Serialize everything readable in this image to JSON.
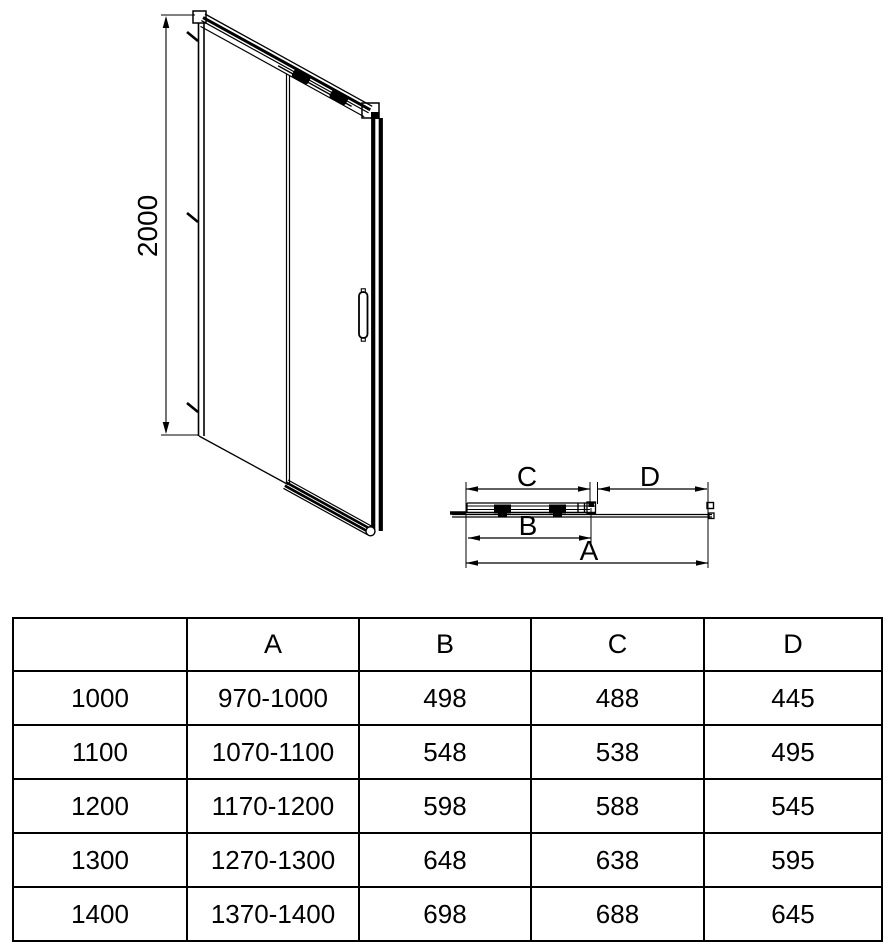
{
  "drawing": {
    "front_view": {
      "height_dim_label": "2000"
    },
    "plan_view": {
      "dim_c_label": "C",
      "dim_d_label": "D",
      "dim_b_label": "B",
      "dim_a_label": "A"
    }
  },
  "table": {
    "headers": [
      "",
      "A",
      "B",
      "C",
      "D"
    ],
    "rows": [
      [
        "1000",
        "970-1000",
        "498",
        "488",
        "445"
      ],
      [
        "1100",
        "1070-1100",
        "548",
        "538",
        "495"
      ],
      [
        "1200",
        "1170-1200",
        "598",
        "588",
        "545"
      ],
      [
        "1300",
        "1270-1300",
        "648",
        "638",
        "595"
      ],
      [
        "1400",
        "1370-1400",
        "698",
        "688",
        "645"
      ]
    ]
  },
  "colors": {
    "line": "#000000",
    "background": "#ffffff"
  }
}
